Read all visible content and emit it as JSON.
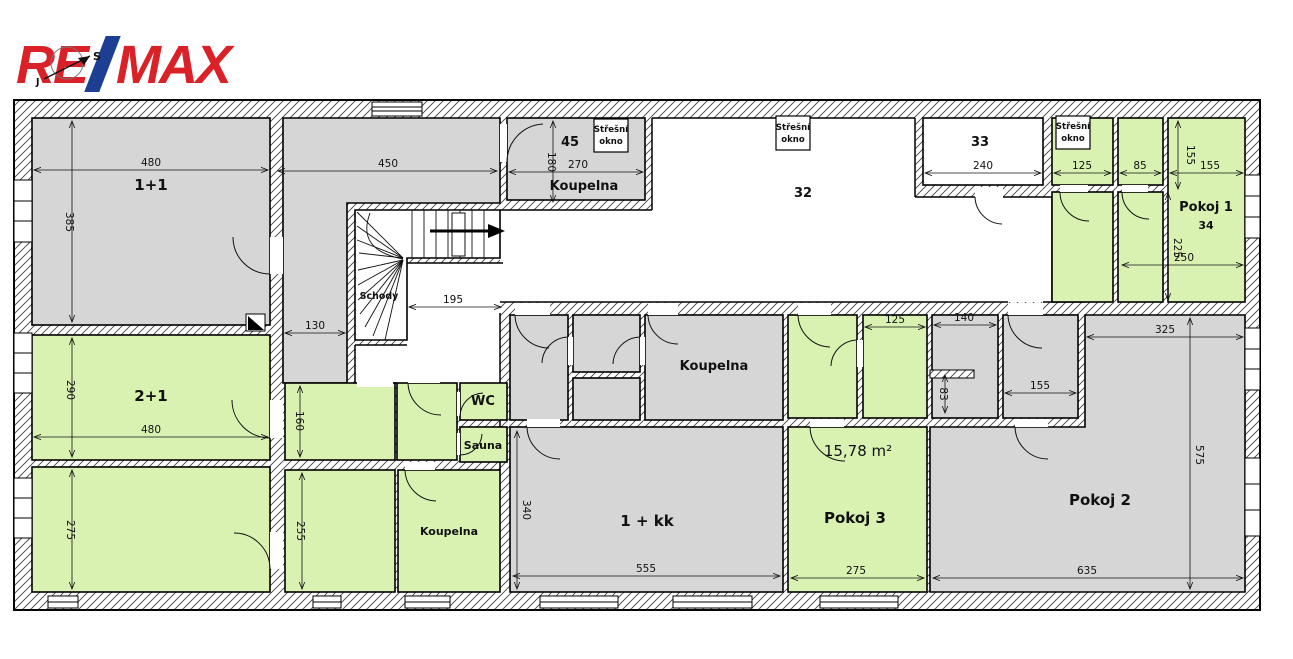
{
  "logo": {
    "re": "RE",
    "slash_color": "#1c3f94",
    "max": "MAX",
    "red": "#da2128"
  },
  "compass": {
    "north": "S",
    "south": "J"
  },
  "colors": {
    "room_green": "#d9f2b2",
    "room_gray": "#d6d6d6",
    "wall_line": "#000000"
  },
  "rooms": {
    "r11": {
      "label": "1+1"
    },
    "r21": {
      "label": "2+1"
    },
    "koupelna_top": {
      "label": "Koupelna",
      "number": "45"
    },
    "schody": {
      "label": "Schody"
    },
    "room32": {
      "label": "32"
    },
    "room33": {
      "label": "33"
    },
    "pokoj1": {
      "label": "Pokoj 1",
      "number": "34"
    },
    "wc": {
      "label": "WC"
    },
    "sauna": {
      "label": "Sauna"
    },
    "koupelna_mid": {
      "label": "Koupelna"
    },
    "koupelna_bottom": {
      "label": "Koupelna"
    },
    "kk": {
      "label": "1 + kk"
    },
    "pokoj3": {
      "label": "Pokoj 3",
      "area": "15,78 m²"
    },
    "pokoj2": {
      "label": "Pokoj 2"
    },
    "roof_window": {
      "line1": "Střešní",
      "line2": "okno"
    }
  },
  "dims": {
    "d480a": "480",
    "d385": "385",
    "d450": "450",
    "d130": "130",
    "d195": "195",
    "d180": "180",
    "d270": "270",
    "d240": "240",
    "d125a": "125",
    "d85": "85",
    "d155v": "155",
    "d155h": "155",
    "d225": "225",
    "d250": "250",
    "d290": "290",
    "d480b": "480",
    "d160": "160",
    "d275a": "275",
    "d255": "255",
    "d340": "340",
    "d555": "555",
    "d275b": "275",
    "d125b": "125",
    "d140": "140",
    "d83": "83",
    "d155c": "155",
    "d325": "325",
    "d575": "575",
    "d635": "635"
  }
}
